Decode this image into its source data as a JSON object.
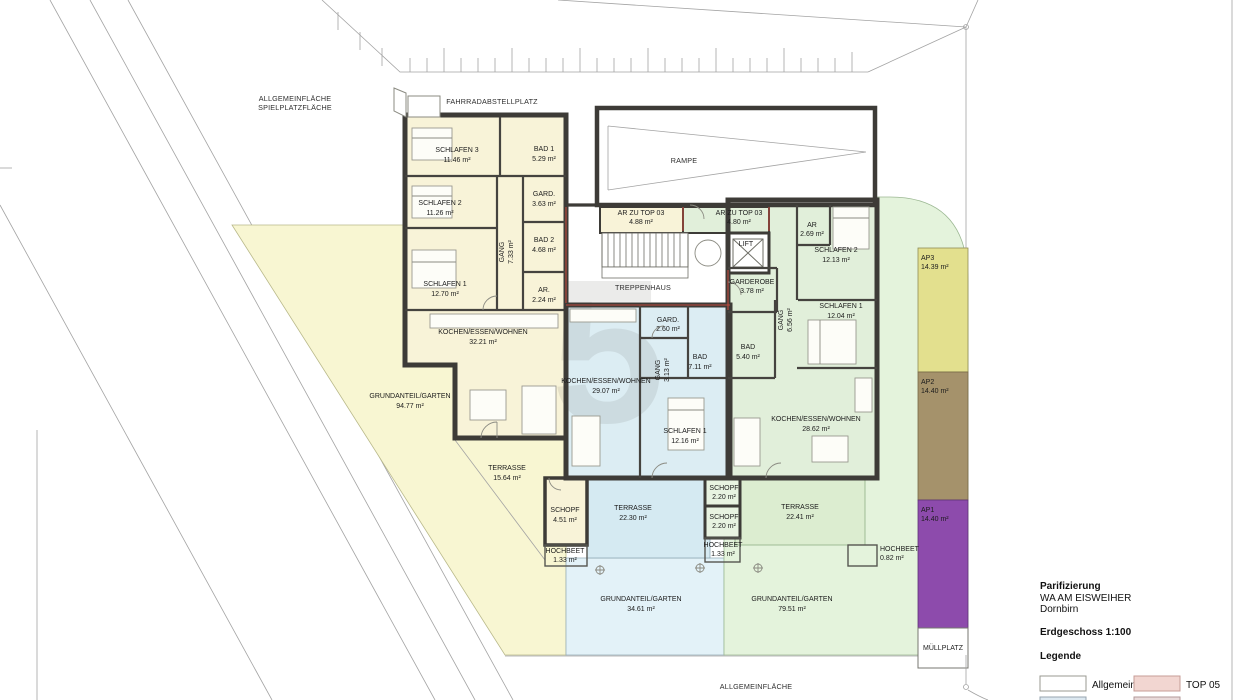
{
  "site": {
    "allgemein_line1": "ALLGEMEINFLÄCHE",
    "allgemein_line2": "SPIELPLATZFLÄCHE",
    "fahrradabstellplatz": "FAHRRADABSTELLPLATZ",
    "rampe": "RAMPE",
    "treppenhaus": "TREPPENHAUS",
    "lift": "LIFT",
    "muellplatz": "MÜLLPLATZ",
    "allgemein_bottom": "ALLGEMEINFLÄCHE"
  },
  "watermark": "5",
  "rooms": [
    {
      "name": "SCHLAFEN 3",
      "area": "11.46 m²"
    },
    {
      "name": "BAD 1",
      "area": "5.29 m²"
    },
    {
      "name": "SCHLAFEN 2",
      "area": "11.26 m²"
    },
    {
      "name": "GARD.",
      "area": "3.63 m²"
    },
    {
      "name": "BAD 2",
      "area": "4.68 m²"
    },
    {
      "name": "GANG",
      "area": "7.33 m²"
    },
    {
      "name": "SCHLAFEN 1",
      "area": "12.70 m²"
    },
    {
      "name": "AR.",
      "area": "2.24 m²"
    },
    {
      "name": "KOCHEN/ESSEN/WOHNEN",
      "area": "32.21 m²"
    },
    {
      "name": "GRUNDANTEIL/GARTEN",
      "area": "94.77 m²"
    },
    {
      "name": "TERRASSE",
      "area": "15.64 m²"
    },
    {
      "name": "SCHOPF",
      "area": "4.51 m²"
    },
    {
      "name": "HOCHBEET",
      "area": "1.33 m²"
    },
    {
      "name": "AR ZU TOP 03",
      "area": "4.88 m²"
    },
    {
      "name": "AR ZU TOP 03",
      "area": "4.80 m²"
    },
    {
      "name": "GARD.",
      "area": "2.60 m²"
    },
    {
      "name": "GANG",
      "area": "3.13 m²"
    },
    {
      "name": "BAD",
      "area": "7.11 m²"
    },
    {
      "name": "KOCHEN/ESSEN/WOHNEN",
      "area": "29.07 m²"
    },
    {
      "name": "SCHLAFEN 1",
      "area": "12.16 m²"
    },
    {
      "name": "TERRASSE",
      "area": "22.30 m²"
    },
    {
      "name": "SCHOPF",
      "area": "2.20 m²"
    },
    {
      "name": "SCHOPF",
      "area": "2.20 m²"
    },
    {
      "name": "HOCHBEET",
      "area": "1.33 m²"
    },
    {
      "name": "GRUNDANTEIL/GARTEN",
      "area": "34.61 m²"
    },
    {
      "name": "AR",
      "area": "2.69 m²"
    },
    {
      "name": "SCHLAFEN 2",
      "area": "12.13 m²"
    },
    {
      "name": "GARDEROBE",
      "area": "3.78 m²"
    },
    {
      "name": "GANG",
      "area": "6.56 m²"
    },
    {
      "name": "SCHLAFEN 1",
      "area": "12.04 m²"
    },
    {
      "name": "BAD",
      "area": "5.40 m²"
    },
    {
      "name": "KOCHEN/ESSEN/WOHNEN",
      "area": "28.62 m²"
    },
    {
      "name": "TERRASSE",
      "area": "22.41 m²"
    },
    {
      "name": "HOCHBEET",
      "area": "0.82 m²"
    },
    {
      "name": "GRUNDANTEIL/GARTEN",
      "area": "79.51 m²"
    }
  ],
  "ap_areas": [
    {
      "label": "AP3",
      "area": "14.39 m²"
    },
    {
      "label": "AP2",
      "area": "14.40 m²"
    },
    {
      "label": "AP1",
      "area": "14.40 m²"
    }
  ],
  "title_block": {
    "heading": "Parifizierung",
    "project": "WA AM EISWEIHER",
    "city": "Dornbirn",
    "floor": "Erdgeschoss 1:100",
    "legend_heading": "Legende",
    "legend": [
      {
        "label": "Allgemein"
      },
      {
        "label": "TOP 05"
      }
    ]
  },
  "colors": {
    "apartment_left": "#f8f3d8",
    "apartment_middle": "#dcedf3",
    "apartment_right": "#e1efda",
    "garden_left": "#f8f6d2",
    "garden_middle": "#e3f2f8",
    "garden_right": "#e4f3dc",
    "terrace_middle": "#d5eaf2",
    "terrace_right": "#dcedd0",
    "schopf_mid": "#e8f3e1",
    "ap3": "#e3e08e",
    "ap2": "#a5926b",
    "ap1": "#8d4bac",
    "legend_allgemein": "#ffffff",
    "legend_top05": "#f2d6d1",
    "legend_row2_a": "#dce8f0",
    "legend_row2_b": "#e9dada"
  }
}
